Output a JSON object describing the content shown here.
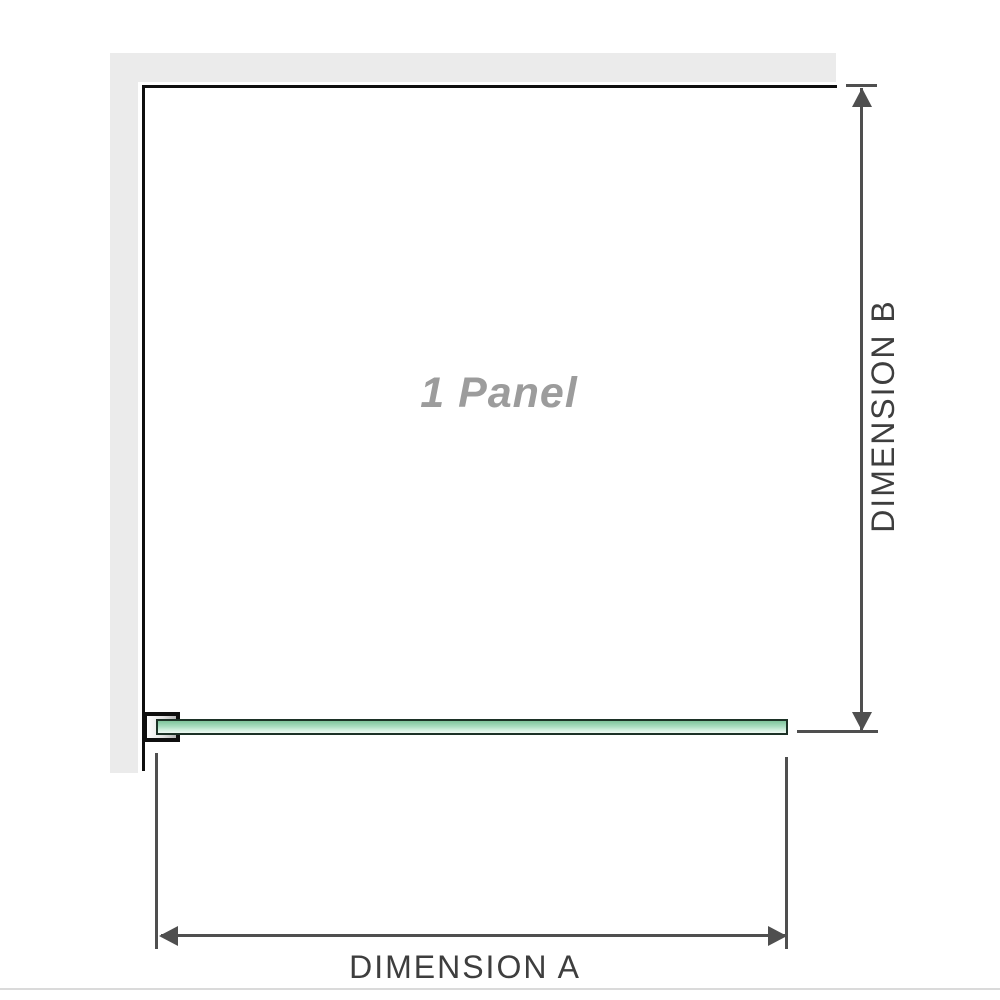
{
  "diagram": {
    "panel_label": "1 Panel",
    "dimension_a": {
      "label": "DIMENSION A"
    },
    "dimension_b": {
      "label": "DIMENSION B"
    }
  },
  "colors": {
    "wall": "#ebebeb",
    "outline": "#0f0f0f",
    "glass_top": "#7fc49c",
    "glass_mid": "#a9dcc0",
    "glass_light": "#d8f1e3",
    "glass_border": "#1c3126",
    "dim": "#4f4f4f",
    "dim_text": "#3e3e3e",
    "panel_text": "#9c9c9c",
    "faint_line": "#dadada"
  }
}
